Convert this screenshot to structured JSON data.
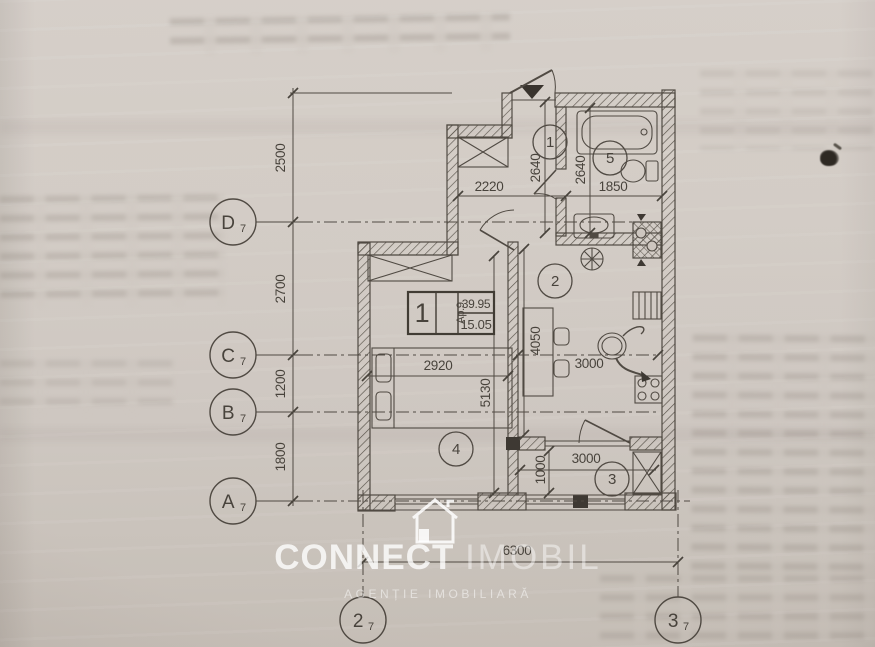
{
  "watermark": {
    "brand": "CONNECT",
    "brand2": "IMOBIL",
    "tagline": "AGENȚIE IMOBILIARĂ"
  },
  "stamp": {
    "number": "1",
    "unit": "Ap.9",
    "area_total": "39.95",
    "area_living": "15.05"
  },
  "rooms": {
    "hall": "1",
    "kitchen": "2",
    "balcony": "3",
    "living": "4",
    "bath": "5"
  },
  "axes": {
    "row_d": {
      "letter": "D",
      "index": "7"
    },
    "row_c": {
      "letter": "C",
      "index": "7"
    },
    "row_b": {
      "letter": "B",
      "index": "7"
    },
    "row_a": {
      "letter": "A",
      "index": "7"
    },
    "col_2": {
      "letter": "2",
      "index": "7"
    },
    "col_3": {
      "letter": "3",
      "index": "7"
    }
  },
  "dimensions": {
    "vertical_chain": [
      "2500",
      "2700",
      "1200",
      "1800"
    ],
    "hall_width": "2220",
    "hall_depth": "2640",
    "bath_depth": "2640",
    "bath_width": "1850",
    "living_width": "2920",
    "living_depth": "5130",
    "kitchen_depth": "4050",
    "kitchen_width": "3000",
    "balcony_depth": "1000",
    "balcony_width": "3000",
    "total_width": "6300"
  },
  "colors": {
    "paper": "#cdc6bf",
    "ink_line": "#4b453e",
    "watermark": "#ffffff"
  }
}
